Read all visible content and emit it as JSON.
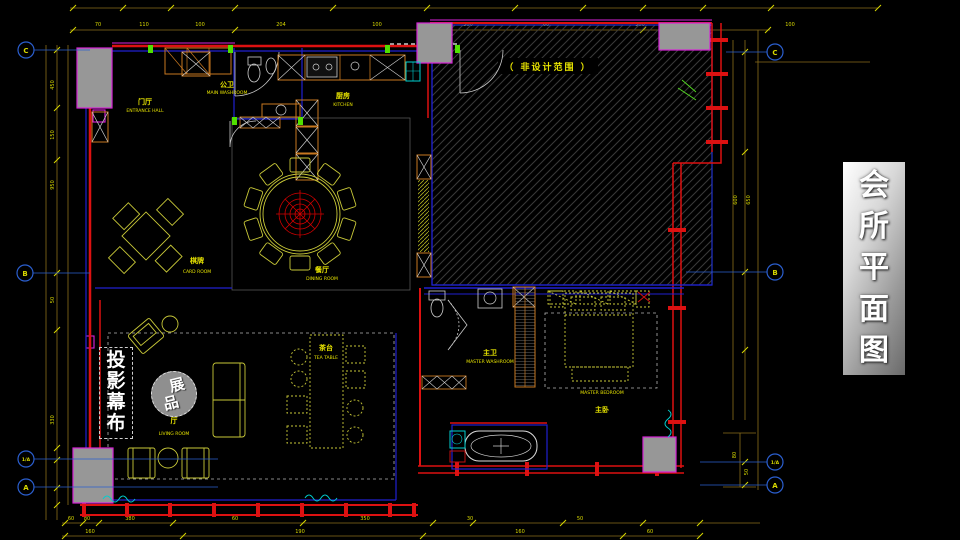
{
  "banner": {
    "title": "会所平面图",
    "chars": [
      "会",
      "所",
      "平",
      "面",
      "图"
    ]
  },
  "overlay": {
    "projection_screen": {
      "text": "投影幕布",
      "chars": [
        "投",
        "影",
        "幕",
        "布"
      ]
    },
    "exhibit": {
      "text": "展品",
      "chars": [
        "展",
        "品"
      ]
    }
  },
  "plan": {
    "non_design_area_label": "（ 非设计范围 ）",
    "rooms": [
      {
        "id": "entrance-hall",
        "zh": "门厅",
        "en": "ENTRANCE HALL"
      },
      {
        "id": "main-washroom",
        "zh": "公卫",
        "en": "MAIN WASHROOM"
      },
      {
        "id": "kitchen",
        "zh": "厨房",
        "en": "KITCHEN"
      },
      {
        "id": "dining-room",
        "zh": "餐厅",
        "en": "DINING ROOM"
      },
      {
        "id": "card-room",
        "zh": "棋牌",
        "en": "CARD ROOM"
      },
      {
        "id": "tea-table",
        "zh": "茶台",
        "en": "TEA TABLE"
      },
      {
        "id": "living-room",
        "zh": "厅",
        "en": "LIVING ROOM"
      },
      {
        "id": "master-washroom",
        "zh": "主卫",
        "en": "MASTER WASHROOM"
      },
      {
        "id": "master-bedroom",
        "zh": "主卧",
        "en": "MASTER BEDROOM"
      }
    ],
    "grid_markers": {
      "left": [
        {
          "label": "C"
        },
        {
          "label": "B"
        },
        {
          "label": "1/A"
        },
        {
          "label": "A"
        }
      ],
      "right": [
        {
          "label": "C"
        },
        {
          "label": "B"
        },
        {
          "label": "1/A"
        },
        {
          "label": "A"
        }
      ]
    },
    "dimensions": {
      "top": [
        "70",
        "110",
        "100",
        "204",
        "100",
        "300",
        "60",
        "300",
        "100"
      ],
      "left": [
        "450",
        "150",
        "950",
        "50",
        "330"
      ],
      "right": [
        "600",
        "650"
      ],
      "right_lower": [
        "80",
        "50"
      ],
      "bottom_upper": [
        "60",
        "80",
        "380",
        "60",
        "350",
        "30",
        "50"
      ],
      "bottom_lower": [
        "160",
        "190",
        "160",
        "60"
      ]
    }
  },
  "colors": {
    "wall_red": "#dd1111",
    "line_blue": "#2020d0",
    "magenta": "#dd22dd",
    "fixture_yellow": "#c8c838",
    "cabinet_orange": "#c87820",
    "dimension_gold": "#8a6d1a",
    "label_yellow": "#e8e400",
    "cyan": "#00cfcf",
    "column_gray": "#979797",
    "banner_text": "#ffffff"
  }
}
